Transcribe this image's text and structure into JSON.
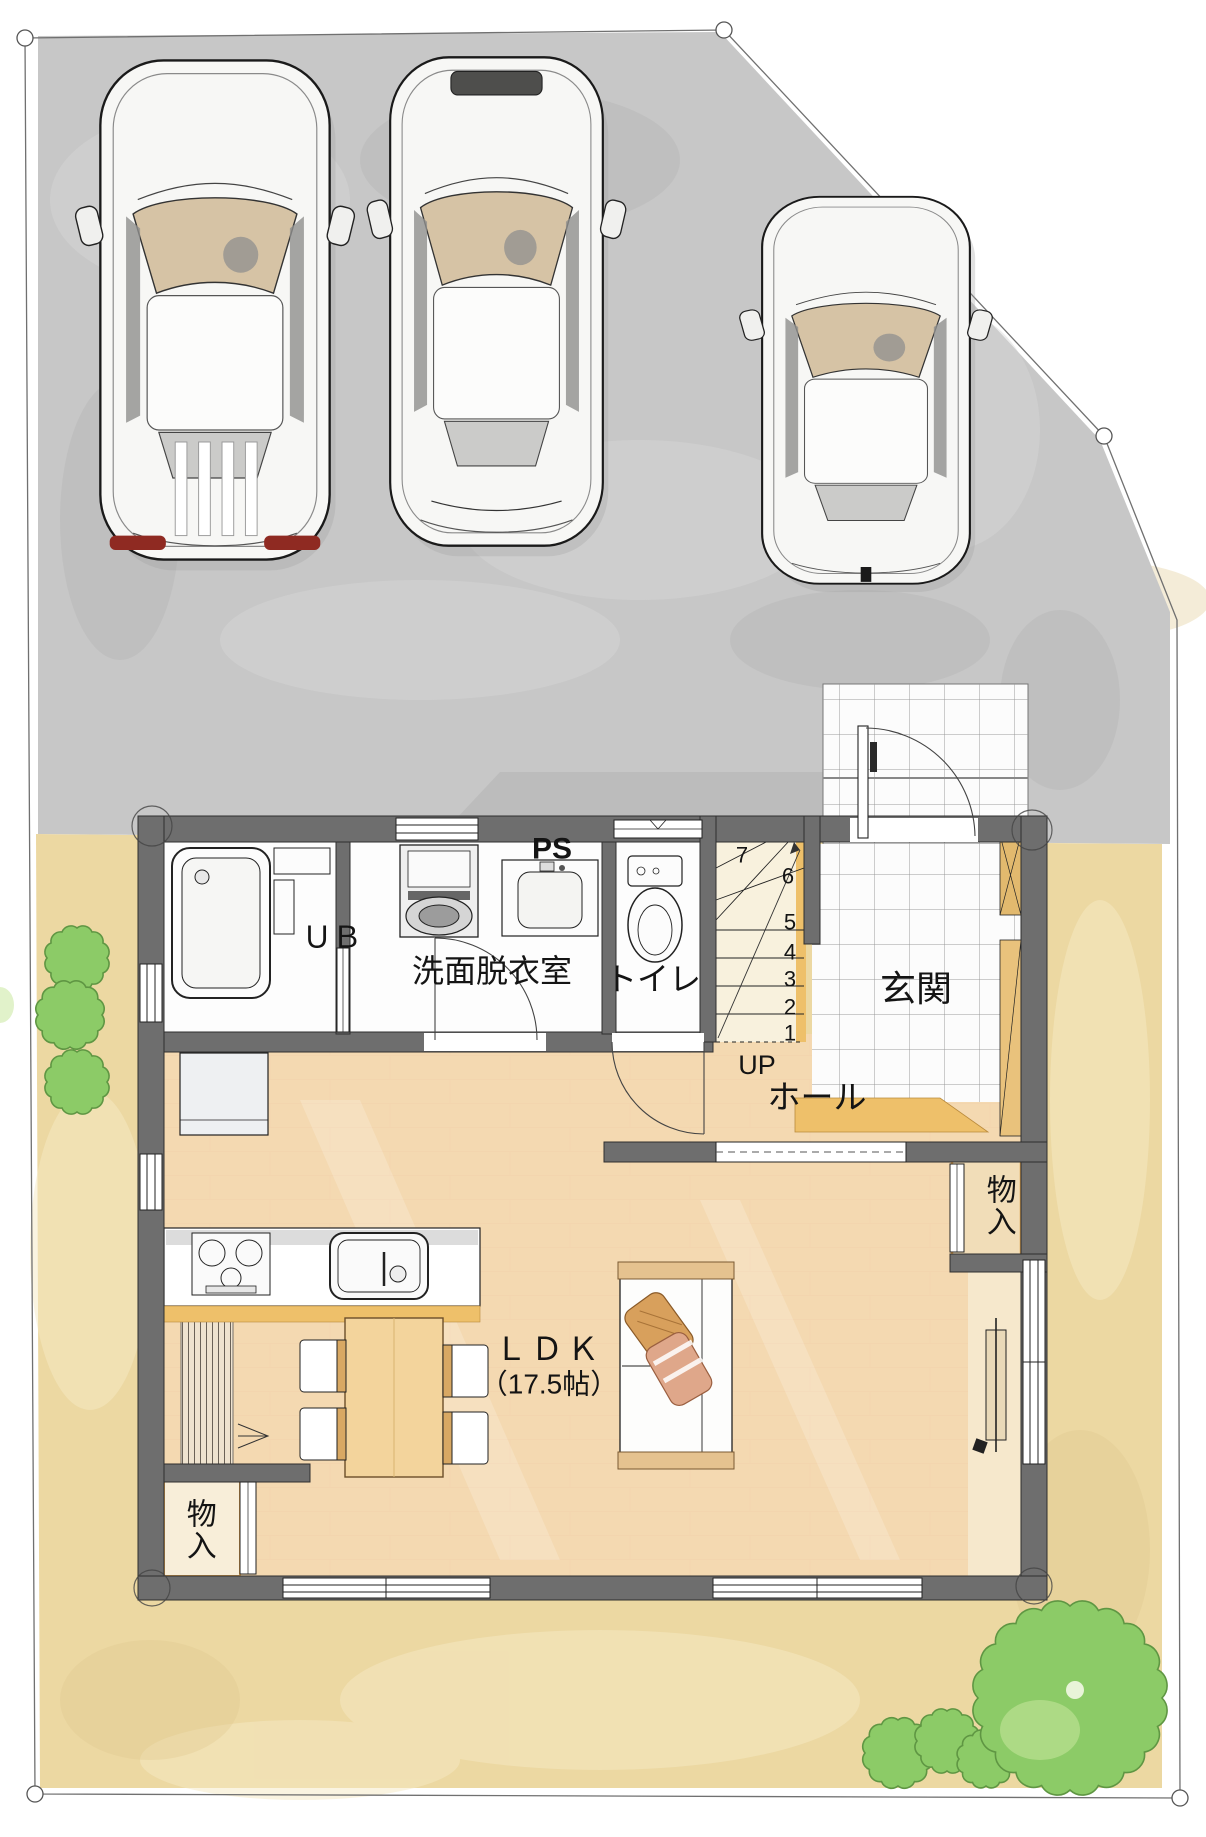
{
  "floorplan": {
    "rooms": {
      "unit_bath": "ＵＢ",
      "washroom": "洗面脱衣室",
      "pipe_space": "PS",
      "toilet": "トイレ",
      "entrance": "玄関",
      "hall": "ホール",
      "ldk_name": "ＬＤＫ",
      "ldk_size": "（17.5帖）",
      "storage_right": "物入",
      "storage_left": "物入"
    },
    "stairs": {
      "direction_label": "UP",
      "step_numbers": [
        "1",
        "2",
        "3",
        "4",
        "5",
        "6",
        "7"
      ]
    },
    "colors": {
      "driveway": "#c7c7c7",
      "yard": "#ecd8a2",
      "wood_floor": "#f6d9b5",
      "tile": "#fcfcfc",
      "wall": "#6e6e6e",
      "stair_floor": "#f8f1dd",
      "accent_wood": "#eec06a",
      "tree_green": "#8ccb67",
      "car_body": "#f7f7f5",
      "taillight_red": "#8f2a22"
    }
  }
}
